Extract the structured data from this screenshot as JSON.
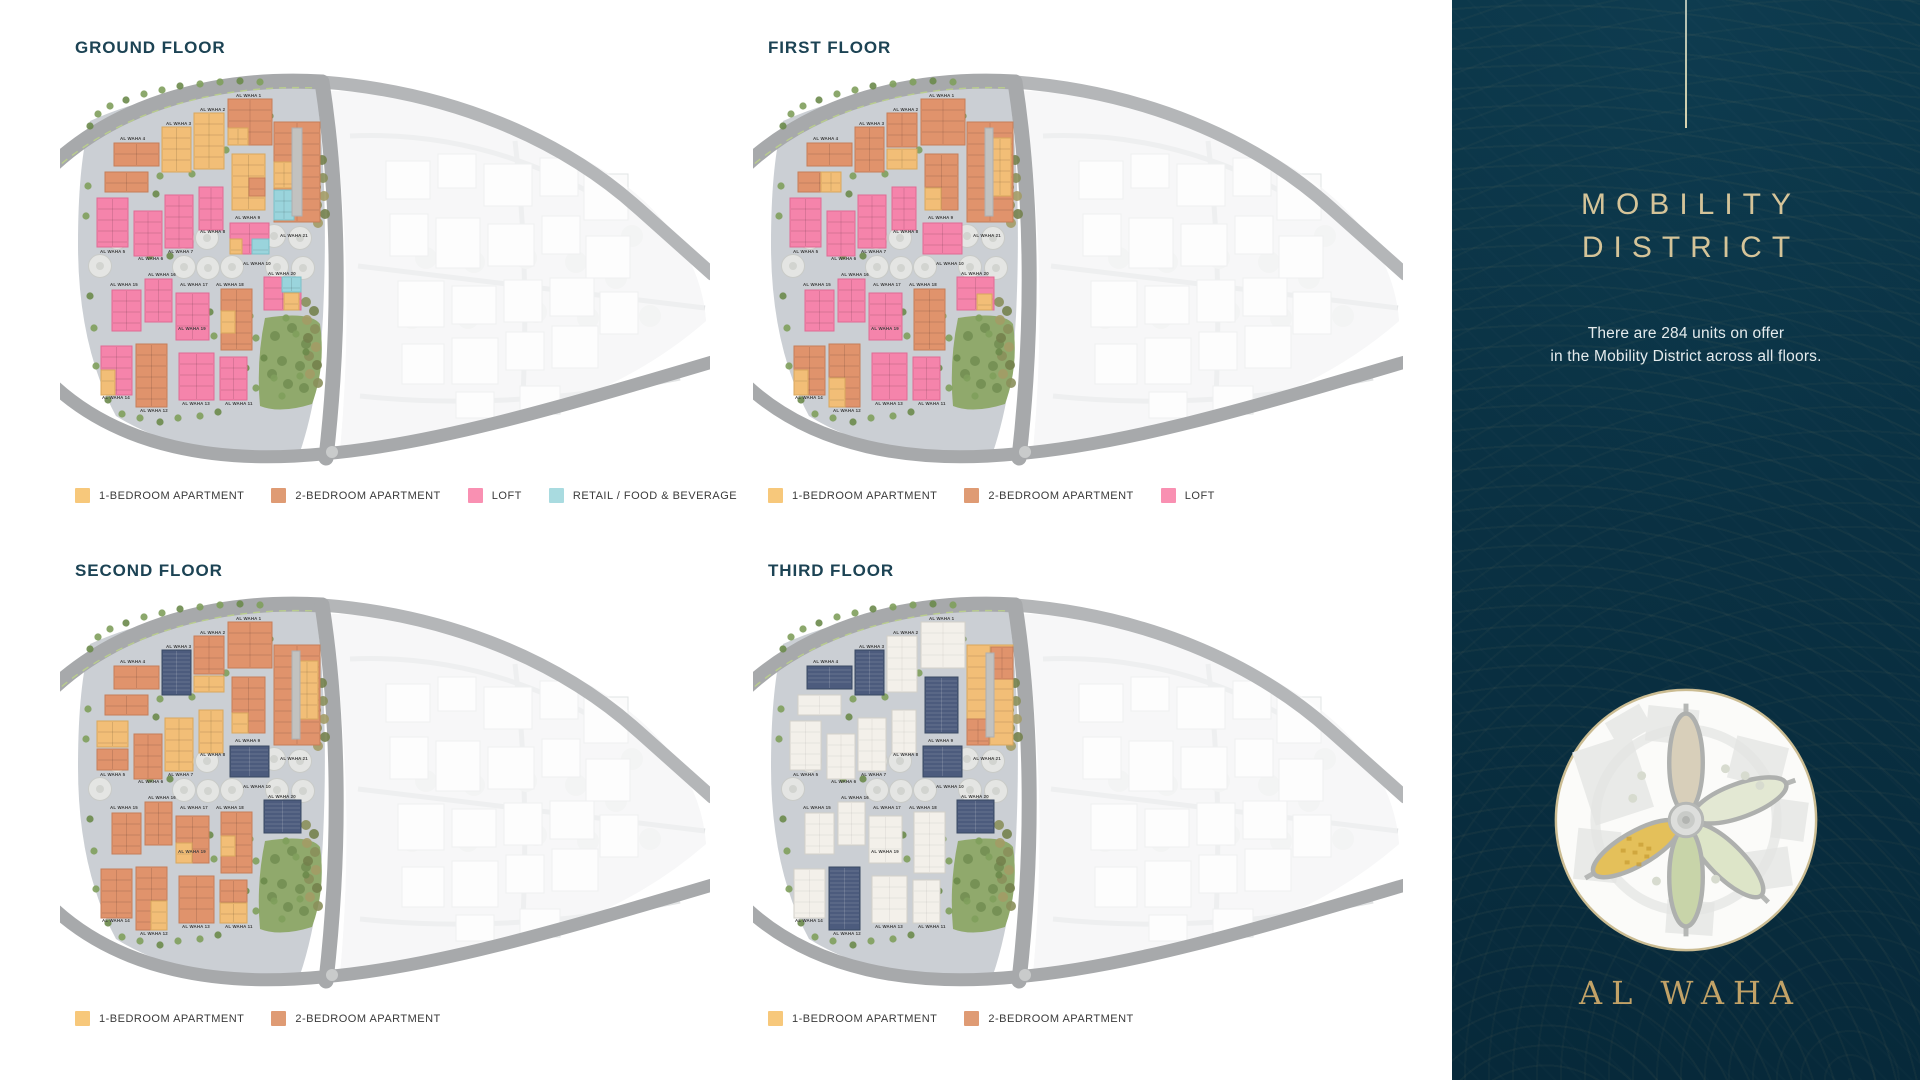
{
  "palette": {
    "y": "#F2BE77",
    "o": "#E0936C",
    "p": "#F584AB",
    "r": "#9AD4DC",
    "s": "#4C5B7D",
    "w": "#F3F0EA",
    "g": "#C2C2C0"
  },
  "floors": [
    {
      "title": "GROUND FLOOR",
      "legend": [
        {
          "label": "1-BEDROOM APARTMENT",
          "color": "#F7C87B"
        },
        {
          "label": "2-BEDROOM APARTMENT",
          "color": "#DF9B74"
        },
        {
          "label": "LOFT",
          "color": "#F990B2"
        },
        {
          "label": "RETAIL / FOOD & BEVERAGE",
          "color": "#A9DBE0"
        }
      ],
      "buildings": [
        [
          168,
          33,
          44,
          46,
          "o"
        ],
        [
          168,
          62,
          20,
          17,
          "y"
        ],
        [
          134,
          47,
          30,
          56,
          "y"
        ],
        [
          102,
          61,
          29,
          45,
          "y"
        ],
        [
          54,
          77,
          45,
          23,
          "o"
        ],
        [
          45,
          106,
          43,
          20,
          "o"
        ],
        [
          214,
          56,
          46,
          100,
          "o"
        ],
        [
          214,
          96,
          20,
          26,
          "y"
        ],
        [
          214,
          124,
          20,
          30,
          "r"
        ],
        [
          232,
          62,
          10,
          88,
          "g"
        ],
        [
          172,
          88,
          33,
          56,
          "y"
        ],
        [
          189,
          112,
          16,
          18,
          "o"
        ],
        [
          37,
          132,
          31,
          49,
          "p"
        ],
        [
          74,
          145,
          28,
          45,
          "p"
        ],
        [
          105,
          129,
          28,
          53,
          "p"
        ],
        [
          139,
          121,
          24,
          43,
          "p"
        ],
        [
          170,
          157,
          39,
          31,
          "p"
        ],
        [
          192,
          173,
          17,
          15,
          "r"
        ],
        [
          170,
          173,
          12,
          15,
          "y"
        ],
        [
          204,
          211,
          37,
          33,
          "p"
        ],
        [
          222,
          211,
          19,
          15,
          "r"
        ],
        [
          224,
          227,
          15,
          17,
          "y"
        ],
        [
          52,
          224,
          29,
          41,
          "p"
        ],
        [
          85,
          213,
          27,
          43,
          "p"
        ],
        [
          116,
          227,
          33,
          47,
          "p"
        ],
        [
          161,
          223,
          31,
          61,
          "o"
        ],
        [
          161,
          245,
          14,
          22,
          "y"
        ],
        [
          41,
          280,
          31,
          49,
          "p"
        ],
        [
          41,
          304,
          14,
          25,
          "y"
        ],
        [
          76,
          278,
          31,
          63,
          "o"
        ],
        [
          119,
          287,
          35,
          47,
          "p"
        ],
        [
          160,
          291,
          27,
          43,
          "p"
        ]
      ]
    },
    {
      "title": "FIRST FLOOR",
      "legend": [
        {
          "label": "1-BEDROOM APARTMENT",
          "color": "#F7C87B"
        },
        {
          "label": "2-BEDROOM APARTMENT",
          "color": "#DF9B74"
        },
        {
          "label": "LOFT",
          "color": "#F990B2"
        }
      ],
      "buildings": [
        [
          168,
          33,
          44,
          46,
          "o"
        ],
        [
          134,
          47,
          30,
          34,
          "o"
        ],
        [
          134,
          83,
          30,
          20,
          "y"
        ],
        [
          102,
          61,
          29,
          45,
          "o"
        ],
        [
          54,
          77,
          45,
          23,
          "o"
        ],
        [
          45,
          106,
          43,
          20,
          "o"
        ],
        [
          68,
          106,
          20,
          20,
          "y"
        ],
        [
          214,
          56,
          46,
          100,
          "o"
        ],
        [
          236,
          72,
          22,
          58,
          "y"
        ],
        [
          232,
          62,
          8,
          88,
          "g"
        ],
        [
          172,
          88,
          33,
          56,
          "o"
        ],
        [
          172,
          122,
          16,
          22,
          "y"
        ],
        [
          37,
          132,
          31,
          49,
          "p"
        ],
        [
          74,
          145,
          28,
          45,
          "p"
        ],
        [
          105,
          129,
          28,
          53,
          "p"
        ],
        [
          139,
          121,
          24,
          43,
          "p"
        ],
        [
          170,
          157,
          39,
          31,
          "p"
        ],
        [
          204,
          211,
          37,
          33,
          "p"
        ],
        [
          224,
          228,
          15,
          16,
          "y"
        ],
        [
          52,
          224,
          29,
          41,
          "p"
        ],
        [
          85,
          213,
          27,
          43,
          "p"
        ],
        [
          116,
          227,
          33,
          47,
          "p"
        ],
        [
          161,
          223,
          31,
          61,
          "o"
        ],
        [
          41,
          280,
          31,
          49,
          "o"
        ],
        [
          41,
          304,
          14,
          25,
          "y"
        ],
        [
          76,
          278,
          31,
          63,
          "o"
        ],
        [
          76,
          312,
          16,
          29,
          "y"
        ],
        [
          119,
          287,
          35,
          47,
          "p"
        ],
        [
          160,
          291,
          27,
          43,
          "p"
        ]
      ]
    },
    {
      "title": "SECOND FLOOR",
      "legend": [
        {
          "label": "1-BEDROOM APARTMENT",
          "color": "#F7C87B"
        },
        {
          "label": "2-BEDROOM APARTMENT",
          "color": "#DF9B74"
        }
      ],
      "buildings": [
        [
          168,
          33,
          44,
          46,
          "o"
        ],
        [
          134,
          47,
          30,
          38,
          "o"
        ],
        [
          134,
          87,
          30,
          16,
          "y"
        ],
        [
          102,
          61,
          29,
          45,
          "s"
        ],
        [
          54,
          77,
          45,
          23,
          "o"
        ],
        [
          45,
          106,
          43,
          20,
          "o"
        ],
        [
          214,
          56,
          46,
          100,
          "o"
        ],
        [
          236,
          72,
          22,
          58,
          "y"
        ],
        [
          232,
          62,
          8,
          88,
          "g"
        ],
        [
          172,
          88,
          33,
          56,
          "o"
        ],
        [
          172,
          124,
          16,
          20,
          "y"
        ],
        [
          37,
          132,
          31,
          26,
          "y"
        ],
        [
          37,
          160,
          31,
          21,
          "o"
        ],
        [
          74,
          145,
          28,
          45,
          "o"
        ],
        [
          105,
          129,
          28,
          53,
          "y"
        ],
        [
          139,
          121,
          24,
          43,
          "y"
        ],
        [
          170,
          157,
          39,
          31,
          "s"
        ],
        [
          204,
          211,
          37,
          33,
          "s"
        ],
        [
          52,
          224,
          29,
          41,
          "o"
        ],
        [
          85,
          213,
          27,
          43,
          "o"
        ],
        [
          116,
          227,
          33,
          47,
          "o"
        ],
        [
          116,
          254,
          16,
          20,
          "y"
        ],
        [
          161,
          223,
          31,
          61,
          "o"
        ],
        [
          161,
          247,
          14,
          20,
          "y"
        ],
        [
          41,
          280,
          31,
          49,
          "o"
        ],
        [
          76,
          278,
          31,
          63,
          "o"
        ],
        [
          91,
          312,
          16,
          29,
          "y"
        ],
        [
          119,
          287,
          35,
          47,
          "o"
        ],
        [
          160,
          291,
          27,
          43,
          "o"
        ],
        [
          160,
          314,
          27,
          20,
          "y"
        ]
      ]
    },
    {
      "title": "THIRD FLOOR",
      "legend": [
        {
          "label": "1-BEDROOM APARTMENT",
          "color": "#F7C87B"
        },
        {
          "label": "2-BEDROOM APARTMENT",
          "color": "#DF9B74"
        }
      ],
      "buildings": [
        [
          168,
          33,
          44,
          46,
          "w"
        ],
        [
          134,
          47,
          30,
          56,
          "w"
        ],
        [
          102,
          61,
          29,
          45,
          "s"
        ],
        [
          54,
          77,
          45,
          23,
          "s"
        ],
        [
          45,
          106,
          43,
          20,
          "w"
        ],
        [
          214,
          56,
          46,
          100,
          "y"
        ],
        [
          238,
          58,
          22,
          32,
          "o"
        ],
        [
          214,
          130,
          22,
          26,
          "o"
        ],
        [
          233,
          64,
          8,
          84,
          "g"
        ],
        [
          172,
          88,
          33,
          56,
          "s"
        ],
        [
          37,
          132,
          31,
          49,
          "w"
        ],
        [
          74,
          145,
          28,
          45,
          "w"
        ],
        [
          105,
          129,
          28,
          53,
          "w"
        ],
        [
          139,
          121,
          24,
          43,
          "w"
        ],
        [
          170,
          157,
          39,
          31,
          "s"
        ],
        [
          204,
          211,
          37,
          33,
          "s"
        ],
        [
          52,
          224,
          29,
          41,
          "w"
        ],
        [
          85,
          213,
          27,
          43,
          "w"
        ],
        [
          116,
          227,
          33,
          47,
          "w"
        ],
        [
          161,
          223,
          31,
          61,
          "w"
        ],
        [
          41,
          280,
          31,
          49,
          "w"
        ],
        [
          76,
          278,
          31,
          63,
          "s"
        ],
        [
          119,
          287,
          35,
          47,
          "w"
        ],
        [
          160,
          291,
          27,
          43,
          "w"
        ]
      ]
    }
  ],
  "building_labels": [
    [
      "AL WAHA 1",
      176,
      31
    ],
    [
      "AL WAHA 2",
      140,
      45
    ],
    [
      "AL WAHA 3",
      106,
      59
    ],
    [
      "AL WAHA 4",
      60,
      74
    ],
    [
      "AL WAHA 5",
      40,
      187
    ],
    [
      "AL WAHA 6",
      78,
      194
    ],
    [
      "AL WAHA 7",
      108,
      187
    ],
    [
      "AL WAHA 8",
      140,
      167
    ],
    [
      "AL WAHA 9",
      175,
      153
    ],
    [
      "AL WAHA 10",
      183,
      199
    ],
    [
      "AL WAHA 11",
      165,
      339
    ],
    [
      "AL WAHA 12",
      80,
      346
    ],
    [
      "AL WAHA 13",
      122,
      339
    ],
    [
      "AL WAHA 14",
      42,
      333
    ],
    [
      "AL WAHA 15",
      50,
      220
    ],
    [
      "AL WAHA 16",
      88,
      210
    ],
    [
      "AL WAHA 17",
      120,
      220
    ],
    [
      "AL WAHA 18",
      156,
      220
    ],
    [
      "AL WAHA 19",
      118,
      264
    ],
    [
      "AL WAHA 20",
      208,
      209
    ],
    [
      "AL WAHA 21",
      220,
      171
    ]
  ],
  "panel": {
    "title_lines": [
      "MOBILITY",
      "DISTRICT"
    ],
    "subtitle_lines": [
      "There are 284 units on offer",
      "in the Mobility District across all floors."
    ],
    "brand": "AL WAHA",
    "colors": {
      "background": "#0A3143",
      "title_gold": "#D5C499",
      "brand_gold": "#C2A267",
      "minimap_highlight": "#E4C05A"
    }
  }
}
